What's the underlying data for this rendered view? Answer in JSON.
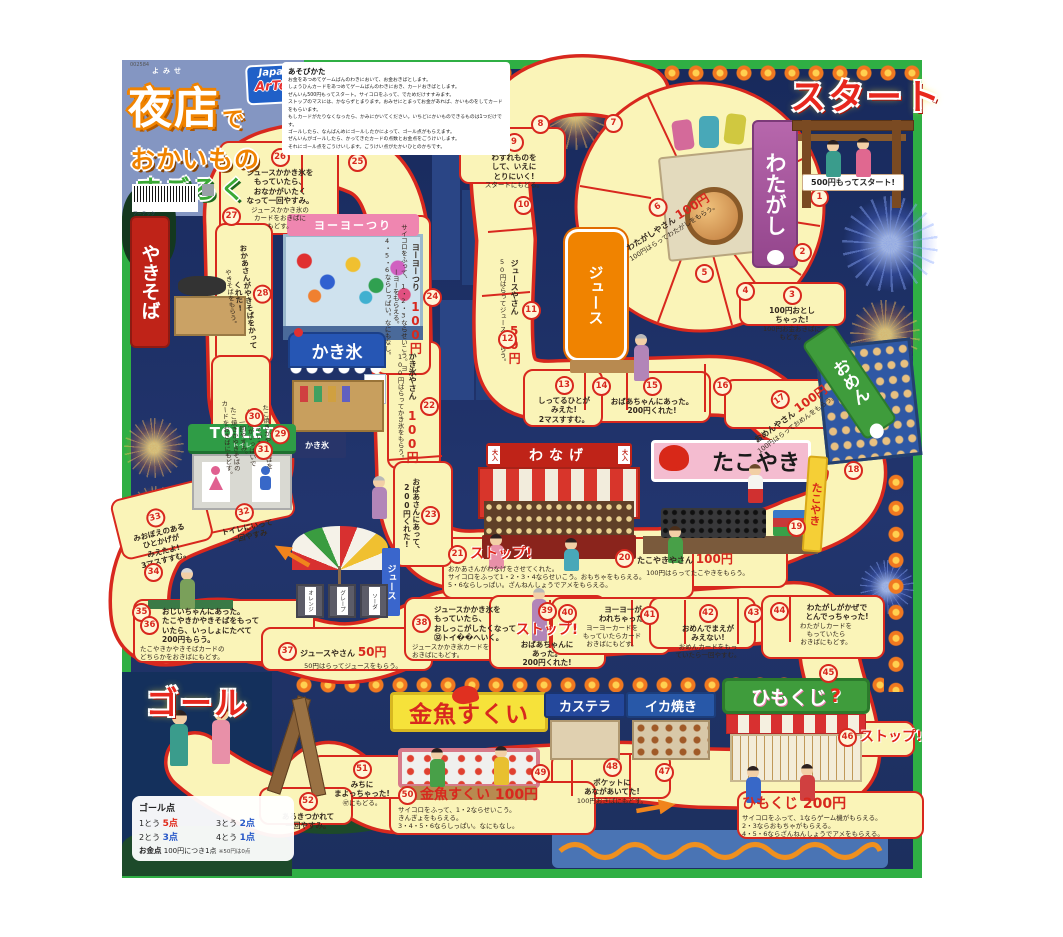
{
  "header": {
    "code": "002584",
    "furigana": "よみせ",
    "title_main": "夜店",
    "title_particle": "で",
    "title_line2": "おかいもの",
    "title_line3": "すごろく",
    "brand_top": "Japan",
    "brand_bottom": "ArTec",
    "maker": "アーテック"
  },
  "instructions": {
    "heading": "あそびかた",
    "lines": [
      "お金をあつめてゲームばんのわきにおいて、お金おきばとします。",
      "しょうひんカードをあつめてゲームばんのわきにおき、カードおきばとします。",
      "ぜんいん500円もってスタート。サイコロをふって、でためだけすすみます。",
      "ストップのマスには、かならずとまります。おみせにとまってお金があれば、かいものをしてカードをもらいます。",
      "もしカードがたりなくなったら、かみにかいてください。いちどにかいものできるものは1つだけです。",
      "ゴールしたら、なんばんめにゴールしたかによって、ゴール点がもらえます。",
      "ぜんいんがゴールしたら、かってきたカードの点数とお金点をごうけいします。",
      "それにゴール点をごうけいします。ごうけい点がたかいひとのかちです。"
    ]
  },
  "start": {
    "label": "スタート",
    "note": "500円もってスタート!"
  },
  "goal": {
    "label": "ゴール"
  },
  "scoring": {
    "goal_title": "ゴール点",
    "rows": [
      {
        "rank": "1とう",
        "pt": "5点"
      },
      {
        "rank": "2とう",
        "pt": "3点"
      },
      {
        "rank": "3とう",
        "pt": "2点"
      },
      {
        "rank": "4とう",
        "pt": "1点"
      }
    ],
    "money_label": "お金点",
    "money_text": "100円につき1点",
    "money_note": "※50円は0点"
  },
  "stalls": {
    "watagashi": {
      "label": "わたがし"
    },
    "juice": {
      "label": "ジュース"
    },
    "omen": {
      "label": "おめん"
    },
    "wanage": {
      "label": "わなげ",
      "badge": "大入"
    },
    "takoyaki": {
      "label": "たこやき",
      "side_label": "たこやき"
    },
    "yakisoba": {
      "label": "やきそば"
    },
    "yoyo": {
      "label": "ヨーヨーつり"
    },
    "kakigori": {
      "label": "かき氷",
      "flag": "氷",
      "noren": "かき氷"
    },
    "toilet": {
      "label": "TOILET",
      "sub": "トイレ"
    },
    "juice_parasol": {
      "banner": "ジュース",
      "boxes": [
        "オレンジ",
        "グレープ",
        "ソーダ"
      ]
    },
    "kingyo": {
      "label": "金魚すくい"
    },
    "kasutera": {
      "label": "カステラ"
    },
    "ikayaki": {
      "label": "イカ焼き"
    },
    "himokuji": {
      "label": "ひもくじ",
      "q": "?"
    }
  },
  "board": {
    "spaces": [
      {
        "n": 1,
        "x": 810,
        "y": 188
      },
      {
        "n": 2,
        "x": 793,
        "y": 243
      },
      {
        "n": 3,
        "x": 742,
        "y": 286,
        "w": 100,
        "em": "100円おとし|ちゃった!",
        "body": "100円お金おきばに|もどす。"
      },
      {
        "n": 4,
        "x": 736,
        "y": 282
      },
      {
        "n": 5,
        "x": 695,
        "y": 264
      },
      {
        "n": 6,
        "x": 612,
        "y": 196,
        "w": 105,
        "rot": -32,
        "head": "わたがしやさん",
        "price": "100円",
        "body": "100円はらってわたがしをもらう。"
      },
      {
        "n": 7,
        "x": 604,
        "y": 114
      },
      {
        "n": 8,
        "x": 531,
        "y": 115
      },
      {
        "n": 9,
        "x": 468,
        "y": 133,
        "w": 92,
        "em": "わすれものを|して、いえに|とりにいく!",
        "body": "スタートにもどる。"
      },
      {
        "n": 10,
        "x": 514,
        "y": 196
      },
      {
        "n": 11,
        "x": 498,
        "y": 252,
        "h": 118,
        "vert": true,
        "head": "ジュースやさん",
        "price": "50円",
        "body": "50円はらってジュースをもらう。"
      },
      {
        "n": 12,
        "x": 498,
        "y": 330
      },
      {
        "n": 13,
        "x": 528,
        "y": 376,
        "w": 72,
        "em": "しってるひとが|みえた!|2マスすすむ。"
      },
      {
        "n": 14,
        "x": 592,
        "y": 377
      },
      {
        "n": 15,
        "x": 598,
        "y": 377,
        "w": 108,
        "em": "おばあちゃんにあった。|200円くれた!"
      },
      {
        "n": 16,
        "x": 713,
        "y": 377
      },
      {
        "n": 17,
        "x": 728,
        "y": 388,
        "w": 118,
        "rot": -36,
        "head": "おめんやさん",
        "price": "100円",
        "body": "100円はらっておめんをもらう。"
      },
      {
        "n": 18,
        "x": 844,
        "y": 461
      },
      {
        "n": 19,
        "x": 787,
        "y": 518
      },
      {
        "n": 20,
        "x": 615,
        "y": 549,
        "w": 165,
        "inline": true,
        "head": "たこやきやさん",
        "price": "100円",
        "body": "100円はらってたこやきをもらう。"
      },
      {
        "n": 21,
        "x": 448,
        "y": 545,
        "w": 240,
        "inline": true,
        "left": true,
        "stop": "ストップ!",
        "body": "おかあさんがわなげをさせてくれた。|サイコロをふって1・2・3・4ならせいこう。おもちゃをもらえる。|5・6ならしっぱい。ざんねんしょうでアメをもらえる。"
      },
      {
        "n": 22,
        "x": 396,
        "y": 348,
        "h": 118,
        "vert": true,
        "head": "かき氷やさん",
        "price": "100円",
        "body": "100円はらってかき氷をもらう。"
      },
      {
        "n": 23,
        "x": 402,
        "y": 468,
        "h": 95,
        "vert": true,
        "em": "おばあさんにあって、|200円くれた!"
      },
      {
        "n": 24,
        "x": 383,
        "y": 222,
        "h": 152,
        "vert": true,
        "head": "ヨーヨーつり",
        "price": "100円",
        "body": "サイコロをふって、1・2・3ならせいこう。ヨーヨーをもらえる。|4・5・6ならしっぱい。なにもなし。"
      },
      {
        "n": 25,
        "x": 348,
        "y": 153
      },
      {
        "n": 26,
        "x": 226,
        "y": 148,
        "w": 108,
        "em": "ジュースかかき氷を|もっていたら、|おなかがいたく|なって一回やすみ。",
        "body": "ジュースかかき氷の|カードをおきばに|もどす。"
      },
      {
        "n": 27,
        "x": 222,
        "y": 207
      },
      {
        "n": 28,
        "x": 226,
        "y": 230,
        "h": 132,
        "vert": true,
        "rot": -6,
        "em": "おかあさんがやきそばをかって|くれた!",
        "body": "やきそばをもらう。"
      },
      {
        "n": 29,
        "x": 222,
        "y": 362,
        "h": 150,
        "vert": true,
        "rot": -4,
        "body": "たこ焼きかやきそばを|もっていたら、|おなかがいっぱいで|一回やすみ。|たこ焼きかやきそばの|カードをおきばにもどす。"
      },
      {
        "n": 30,
        "x": 245,
        "y": 408
      },
      {
        "n": 31,
        "x": 254,
        "y": 441
      },
      {
        "n": 32,
        "x": 200,
        "y": 503,
        "w": 92,
        "rot": -12,
        "em": "トイレにいって|一回やすみ"
      },
      {
        "n": 33,
        "x": 118,
        "y": 508,
        "w": 84,
        "rot": -14,
        "em": "みおぼえのある|ひとかげが|みえたよ!|3マスすすむ。"
      },
      {
        "n": 34,
        "x": 144,
        "y": 563
      },
      {
        "n": 35,
        "x": 132,
        "y": 603
      },
      {
        "n": 36,
        "x": 140,
        "y": 607,
        "w": 168,
        "inline": true,
        "left": true,
        "em": "おじいちゃんにあった。|たこやきかやきそばをもって|いたら、いっしょにたべて|200円もらう。",
        "body": "たこやきかやきそばカードの|どちらかをおきばにもどす。"
      },
      {
        "n": 37,
        "x": 278,
        "y": 642,
        "w": 150,
        "inline": true,
        "head": "ジュースやさん",
        "price": "50円",
        "body": "50円はらってジュースをもらう。"
      },
      {
        "n": 38,
        "x": 412,
        "y": 605,
        "w": 118,
        "inline": true,
        "left": true,
        "em": "ジュースかかき氷を|もっていたら、|おしっこがしたくなって|㉜トイ��へいく。",
        "body": "ジュースかかき氷カードを|おきばにもどす。"
      },
      {
        "n": 39,
        "x": 497,
        "y": 602,
        "w": 100,
        "stop": "ストップ!",
        "em": "おばあちゃんに|あった。|200円くれた!"
      },
      {
        "n": 40,
        "x": 558,
        "y": 604,
        "w": 108,
        "inline": true,
        "em": "ヨーヨーが|われちゃった!",
        "body": "ヨーヨーカードを|もっていたらカード|おきばにもどす。"
      },
      {
        "n": 41,
        "x": 640,
        "y": 606
      },
      {
        "n": 42,
        "x": 658,
        "y": 604,
        "w": 100,
        "em": "おめんでまえが|みえない!",
        "body": "おめんカードをもっ|ていたら一回やすむ。"
      },
      {
        "n": 43,
        "x": 744,
        "y": 604
      },
      {
        "n": 44,
        "x": 770,
        "y": 602,
        "w": 112,
        "inline": true,
        "em": "わたがしがかぜで|とんでっちゃった!",
        "body": "わたがしカードを|もっていたら|おきばにもどす。"
      },
      {
        "n": 45,
        "x": 819,
        "y": 664
      },
      {
        "n": 46,
        "x": 838,
        "y": 728,
        "w": 90,
        "inline": true,
        "stop": "ストップ!"
      },
      {
        "n": 47,
        "x": 655,
        "y": 763
      },
      {
        "n": 48,
        "x": 558,
        "y": 758,
        "w": 108,
        "em": "ポケットに|あながあいてた!",
        "body": "100円おきばにもどす。"
      },
      {
        "n": 49,
        "x": 531,
        "y": 764
      },
      {
        "n": 50,
        "x": 398,
        "y": 786,
        "w": 190,
        "inline": true,
        "left": true,
        "big": true,
        "head": "金魚すくい",
        "price": "100円",
        "body": "サイコロをふって、1・2ならせいこう。|きんぎょをもらえる。|3・4・5・6ならしっぱい。なにもなし。"
      },
      {
        "n": 51,
        "x": 318,
        "y": 760,
        "w": 88,
        "em": "みちに|まよっちゃった!",
        "body": "㊼にもどる。"
      },
      {
        "n": 52,
        "x": 266,
        "y": 792,
        "w": 84,
        "em": "あるきつかれて|一回やすみ。"
      },
      {
        "x": 742,
        "y": 796,
        "w": 178,
        "left": true,
        "big": true,
        "head": "ひもくじ",
        "price": "200円",
        "body": "サイコロをふって、1ならゲーム機がもらえる。|2・3ならおもちゃがもらえる。|4・5・6ならざんねんしょうでアメをもらえる。"
      }
    ]
  }
}
